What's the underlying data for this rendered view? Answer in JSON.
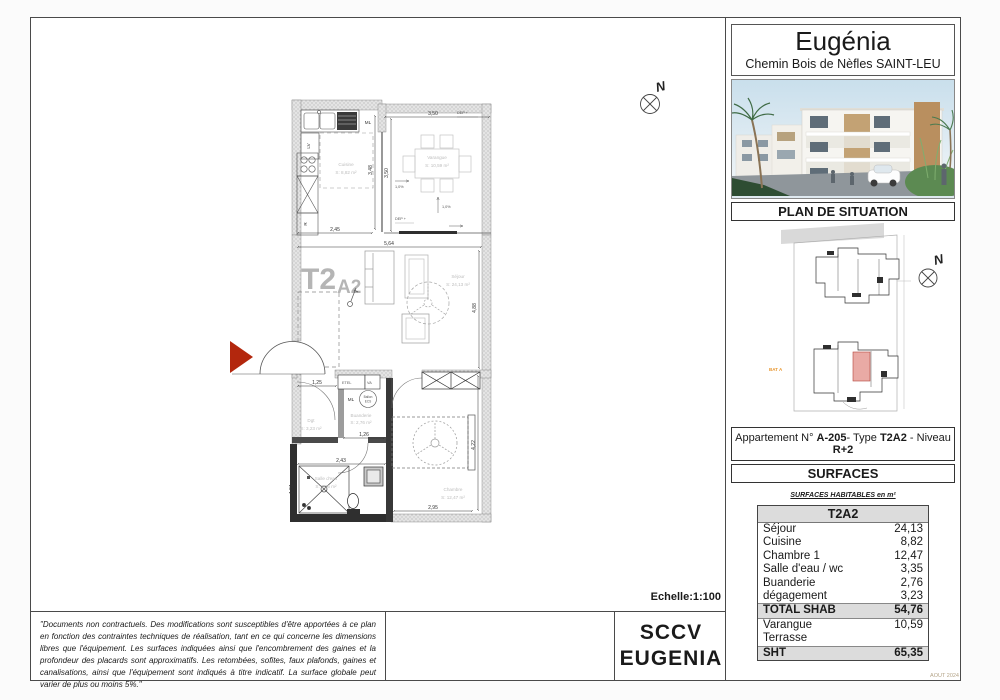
{
  "header": {
    "title": "Eugénia",
    "address": "Chemin Bois de Nèfles SAINT-LEU"
  },
  "situation": {
    "heading": "PLAN DE SITUATION",
    "bat_label": "BAT A",
    "north_letter": "N"
  },
  "apartment": {
    "prefix": "Appartement N° ",
    "number": "A-205",
    "mid1": "- Type ",
    "type": "T2A2",
    "mid2": " - Niveau ",
    "level": "R+2"
  },
  "surfaces": {
    "heading": "SURFACES",
    "table_title": "SURFACES HABITABLES en m²",
    "type_header": "T2A2",
    "rows": [
      {
        "label": "Séjour",
        "value": "24,13"
      },
      {
        "label": "Cuisine",
        "value": "8,82"
      },
      {
        "label": "Chambre 1",
        "value": "12,47"
      },
      {
        "label": "Salle d'eau / wc",
        "value": "3,35"
      },
      {
        "label": "Buanderie",
        "value": "2,76"
      },
      {
        "label": "dégagement",
        "value": "3,23"
      },
      {
        "label": "TOTAL SHAB",
        "value": "54,76"
      },
      {
        "label": "Varangue",
        "value": "10,59"
      },
      {
        "label": "Terrasse",
        "value": ""
      },
      {
        "label": "SHT",
        "value": "65,35"
      }
    ],
    "date_note": "AOUT 2024"
  },
  "sheet": {
    "scale_label": "Echelle:1:100",
    "disclaimer": "\"Documents non contractuels. Des modifications sont susceptibles d'être apportées à ce plan en fonction des contraintes techniques de réalisation, tant en ce qui concerne les dimensions libres que l'équipement. Les surfaces indiquées ainsi que l'encombrement des gaines et la profondeur des placards sont approximatifs. Les retombées, sofites, faux plafonds, gaines et canalisations, ainsi que l'équipement sont indiqués à titre indicatif. La surface globale peut varier de plus ou moins 5%.\"",
    "company_line1": "SCCV",
    "company_line2": "EUGENIA"
  },
  "plan": {
    "type_main": "T2",
    "type_sub": "A2",
    "north_letter": "N",
    "rooms": {
      "cuisine_name": "Cuisine",
      "cuisine_area": "S: 8,82 m²",
      "varangue_name": "Varangue",
      "varangue_area": "S: 10,59 m²",
      "sejour_name": "Séjour",
      "sejour_area": "S: 24,13 m²",
      "chambre_name": "Chambre",
      "chambre_area": "S: 12,47 m²",
      "sde_name": "Salle d'eau",
      "sde_area": "S: 3,35 m²",
      "buanderie_name": "Buanderie",
      "buanderie_area": "S: 2,76 m²",
      "dgt_name": "Dgt",
      "dgt_area": "S: 3,23 m²"
    },
    "labels": {
      "ml_kitchen": "ML",
      "lv": "LV",
      "fridge": "R",
      "ml_buanderie": "ML",
      "etel": "ETEL",
      "va": "VA",
      "ballon_line1": "Ballon",
      "ballon_line2": "ECS",
      "dep_top": "DEP +",
      "dep_bottom": "DEP +",
      "slope_a": "1,0%",
      "slope_b": "1,0%"
    },
    "dims": {
      "kitchen_w": "2,45",
      "sejour_w": "5,64",
      "var_w": "3,50",
      "var_h": "3,50",
      "kitchen_h": "3,48",
      "sejour_h": "4,88",
      "dgt_w": "1,25",
      "buand_w": "1,26",
      "sde_w": "2,43",
      "sde_h": "1,51",
      "chambre_w": "2,95",
      "chambre_h": "4,22"
    },
    "colors": {
      "entry_arrow": "#b3270d",
      "unit_highlight": "#e9aaa5",
      "bat_orange": "#e8962e"
    }
  }
}
